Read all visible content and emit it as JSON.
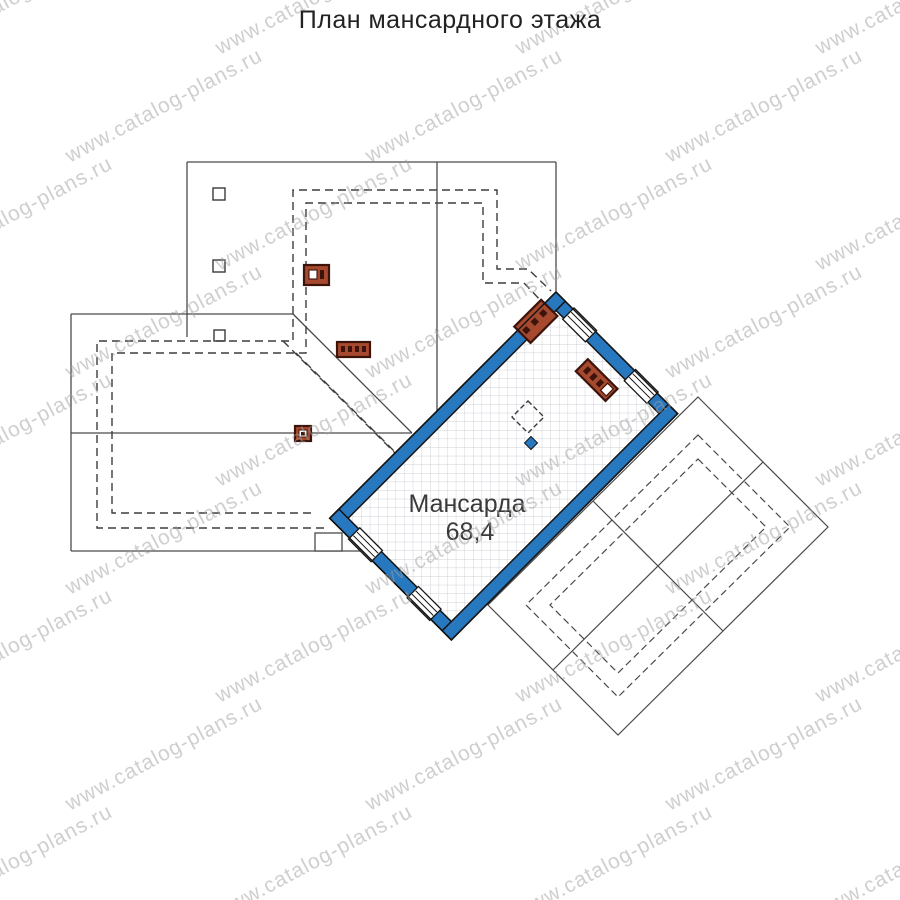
{
  "page_title": "План мансардного этажа",
  "room": {
    "name": "Мансарда",
    "area": "68,4"
  },
  "watermark": {
    "text": "www.catalog-plans.ru"
  },
  "colors": {
    "wall_blue": "#2878c0",
    "wall_outline": "#141414",
    "chimney_brown": "#a7492e",
    "chimney_border": "#3c140b",
    "roof_line": "#4a4a4a",
    "dashed_line": "#3d3d3d",
    "grid_line": "#ccd1d8",
    "text_dark": "#3a3a3a",
    "watermark_gray": "#9e9e9e"
  }
}
